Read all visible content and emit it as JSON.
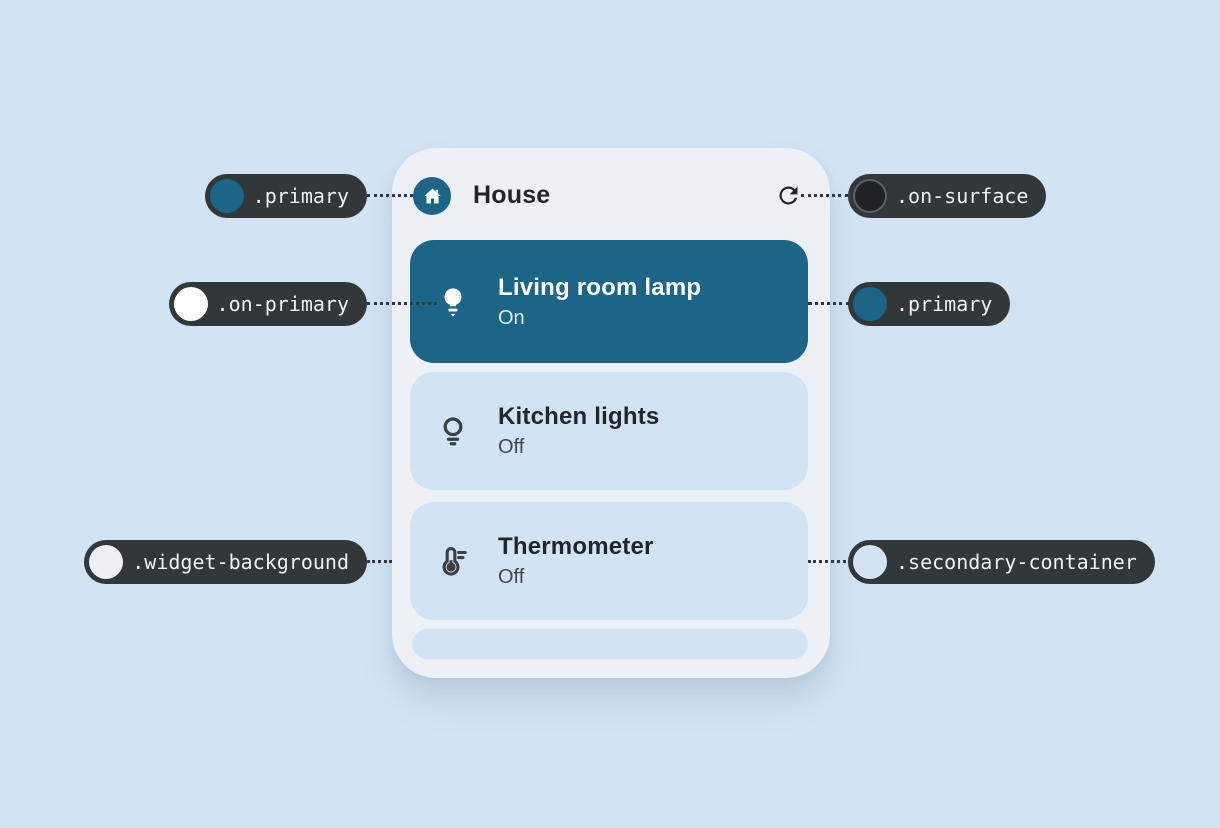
{
  "colors": {
    "page_background": "#d2e4f4",
    "widget_background": "#edf0f5",
    "primary": "#1d6586",
    "on_primary": "#ffffff",
    "on_surface": "#1f2326",
    "secondary_container": "#d2e4f4",
    "pill_background": "#32373a",
    "pill_text": "#eef0f2"
  },
  "widget": {
    "header": {
      "title": "House",
      "icon": "house-icon",
      "action_icon": "refresh-icon"
    },
    "items": [
      {
        "name": "Living room lamp",
        "status": "On",
        "icon": "lightbulb-filled-icon",
        "active": true
      },
      {
        "name": "Kitchen lights",
        "status": "Off",
        "icon": "lightbulb-outline-icon",
        "active": false
      },
      {
        "name": "Thermometer",
        "status": "Off",
        "icon": "thermostat-icon",
        "active": false
      }
    ]
  },
  "callouts": [
    {
      "label": ".primary",
      "swatch": "#1d6586",
      "side": "left"
    },
    {
      "label": ".on-surface",
      "swatch": "#1f2326",
      "side": "right"
    },
    {
      "label": ".on-primary",
      "swatch": "#ffffff",
      "side": "left"
    },
    {
      "label": ".primary",
      "swatch": "#1d6586",
      "side": "right"
    },
    {
      "label": ".widget-background",
      "swatch": "#edf0f5",
      "side": "left"
    },
    {
      "label": ".secondary-container",
      "swatch": "#d2e4f4",
      "side": "right"
    }
  ]
}
